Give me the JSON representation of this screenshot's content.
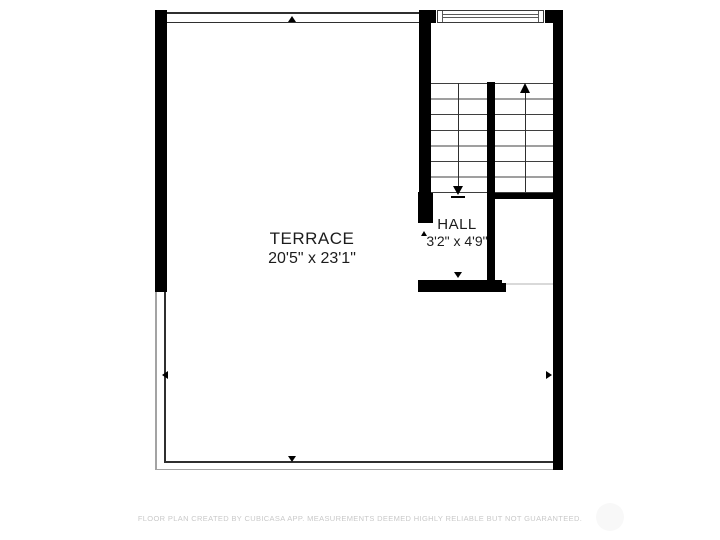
{
  "plan": {
    "rooms": [
      {
        "name": "TERRACE",
        "dimensions": "20'5\" x 23'1\""
      },
      {
        "name": "HALL",
        "dimensions": "3'2\" x 4'9\""
      }
    ],
    "features": {
      "stairs": {
        "flights": 2,
        "direction_markers": [
          "up",
          "down"
        ]
      },
      "window_top": true,
      "opening_markers": [
        "top",
        "bottom",
        "left",
        "right",
        "hall"
      ]
    },
    "colors": {
      "wall": "#000000",
      "thin_line": "#2f2f2f",
      "railing_outer": "#a3a3a3",
      "tread_line": "#3f3f3f",
      "opening_line": "#d9d9d9",
      "label_text": "#1c1c1c",
      "footer_text": "#c9c9c9"
    }
  },
  "footer": {
    "disclaimer": "FLOOR PLAN CREATED BY CUBICASA APP. MEASUREMENTS DEEMED HIGHLY RELIABLE BUT NOT GUARANTEED."
  }
}
